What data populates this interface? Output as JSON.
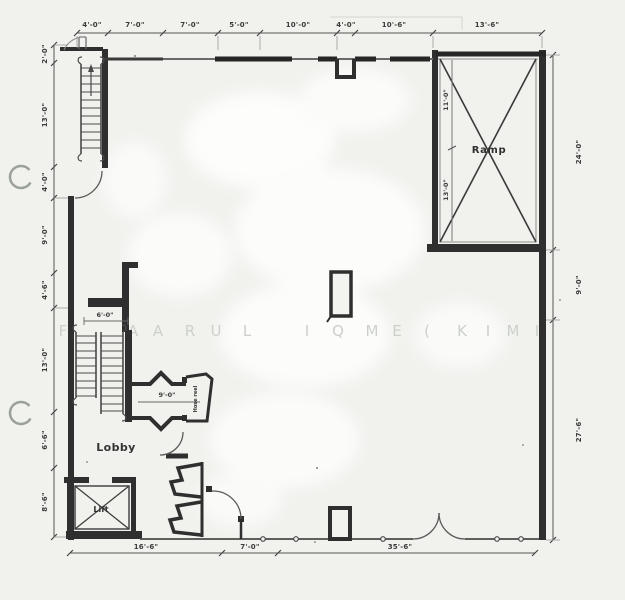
{
  "document": {
    "kind": "scanned-floor-plan",
    "colors": {
      "paper": "#f1f2ee",
      "ink": "#2f2f2f",
      "dim_text": "#3b3b3b",
      "watermark": "#ccd0ca"
    }
  },
  "rooms": {
    "ramp": "Ramp",
    "lobby": "Lobby",
    "lift": "Lift",
    "hose_reel": "Hose reel"
  },
  "dims": {
    "top": [
      "4'-0\"",
      "7'-0\"",
      "7'-0\"",
      "5'-0\"",
      "10'-0\"",
      "4'-0\"",
      "10'-6\"",
      "13'-6\""
    ],
    "left": [
      "2'-0\"",
      "13'-0\"",
      "4'-0\"",
      "9'-0\"",
      "4'-6\"",
      "13'-0\"",
      "6'-6\"",
      "8'-6\""
    ],
    "right": [
      "24'-0\"",
      "9'-0\"",
      "27'-6\""
    ],
    "bottom": [
      "16'-6\"",
      "7'-0\"",
      "35'-6\""
    ],
    "ramp_inner": [
      "11'-0\"",
      "13'-0\""
    ],
    "stair_opening": "6'-0\"",
    "corridor": "9'-0\""
  },
  "watermark": {
    "text": "FA ARUL IQME(KIMI",
    "letters": [
      {
        "ch": "F",
        "x": 63
      },
      {
        "ch": "A",
        "x": 133
      },
      {
        "ch": "A",
        "x": 158
      },
      {
        "ch": "R",
        "x": 190
      },
      {
        "ch": "U",
        "x": 216
      },
      {
        "ch": "L",
        "x": 247
      },
      {
        "ch": "I",
        "x": 307
      },
      {
        "ch": "Q",
        "x": 338
      },
      {
        "ch": "M",
        "x": 372
      },
      {
        "ch": "E",
        "x": 397
      },
      {
        "ch": "(",
        "x": 427
      },
      {
        "ch": "K",
        "x": 462
      },
      {
        "ch": "I",
        "x": 488
      },
      {
        "ch": "M",
        "x": 513
      },
      {
        "ch": "I",
        "x": 537
      }
    ]
  }
}
